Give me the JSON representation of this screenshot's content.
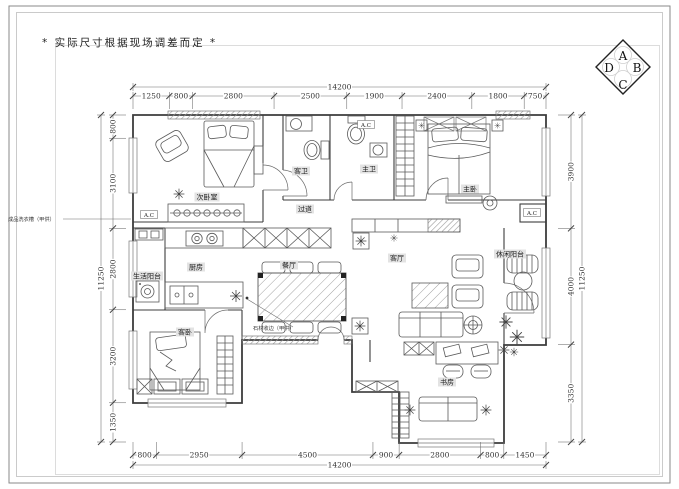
{
  "note_top_left": "* 实际尺寸根据现场调差而定 *",
  "compass": {
    "top": "A",
    "right": "B",
    "bottom": "C",
    "left": "D"
  },
  "dimensions": {
    "top": {
      "total": "14200",
      "segments": [
        "1250",
        "800",
        "2800",
        "2500",
        "1900",
        "2400",
        "1800",
        "750"
      ]
    },
    "bottom": {
      "total": "14200",
      "segments": [
        "800",
        "2950",
        "4500",
        "900",
        "2800",
        "800",
        "1450"
      ]
    },
    "left": {
      "total": "11250",
      "segments": [
        "800",
        "3100",
        "2800",
        "3200",
        "1350"
      ]
    },
    "right": {
      "total": "11250",
      "segments": [
        "3900",
        "4000",
        "3350"
      ]
    }
  },
  "rooms": [
    {
      "label": "次卧室",
      "x": 207,
      "y": 197
    },
    {
      "label": "客卫",
      "x": 301,
      "y": 171
    },
    {
      "label": "主卫",
      "x": 369,
      "y": 169
    },
    {
      "label": "过道",
      "x": 305,
      "y": 209
    },
    {
      "label": "主卧",
      "x": 470,
      "y": 189
    },
    {
      "label": "生活阳台",
      "x": 147,
      "y": 276
    },
    {
      "label": "厨房",
      "x": 196,
      "y": 267
    },
    {
      "label": "餐厅",
      "x": 289,
      "y": 265
    },
    {
      "label": "客厅",
      "x": 397,
      "y": 258
    },
    {
      "label": "休闲阳台",
      "x": 510,
      "y": 254
    },
    {
      "label": "客卧",
      "x": 185,
      "y": 332
    },
    {
      "label": "书房",
      "x": 447,
      "y": 382
    }
  ],
  "annotations": [
    {
      "text": "A.C",
      "x": 149,
      "y": 215,
      "style": "box"
    },
    {
      "text": "A.C",
      "x": 366,
      "y": 125,
      "style": "box"
    },
    {
      "text": "A.C",
      "x": 532,
      "y": 213,
      "style": "box"
    },
    {
      "text": "成品洗衣槽（甲供）",
      "x": 8,
      "y": 221,
      "style": "note"
    },
    {
      "text": "石材收边（甲供）",
      "x": 253,
      "y": 330,
      "style": "note"
    }
  ]
}
